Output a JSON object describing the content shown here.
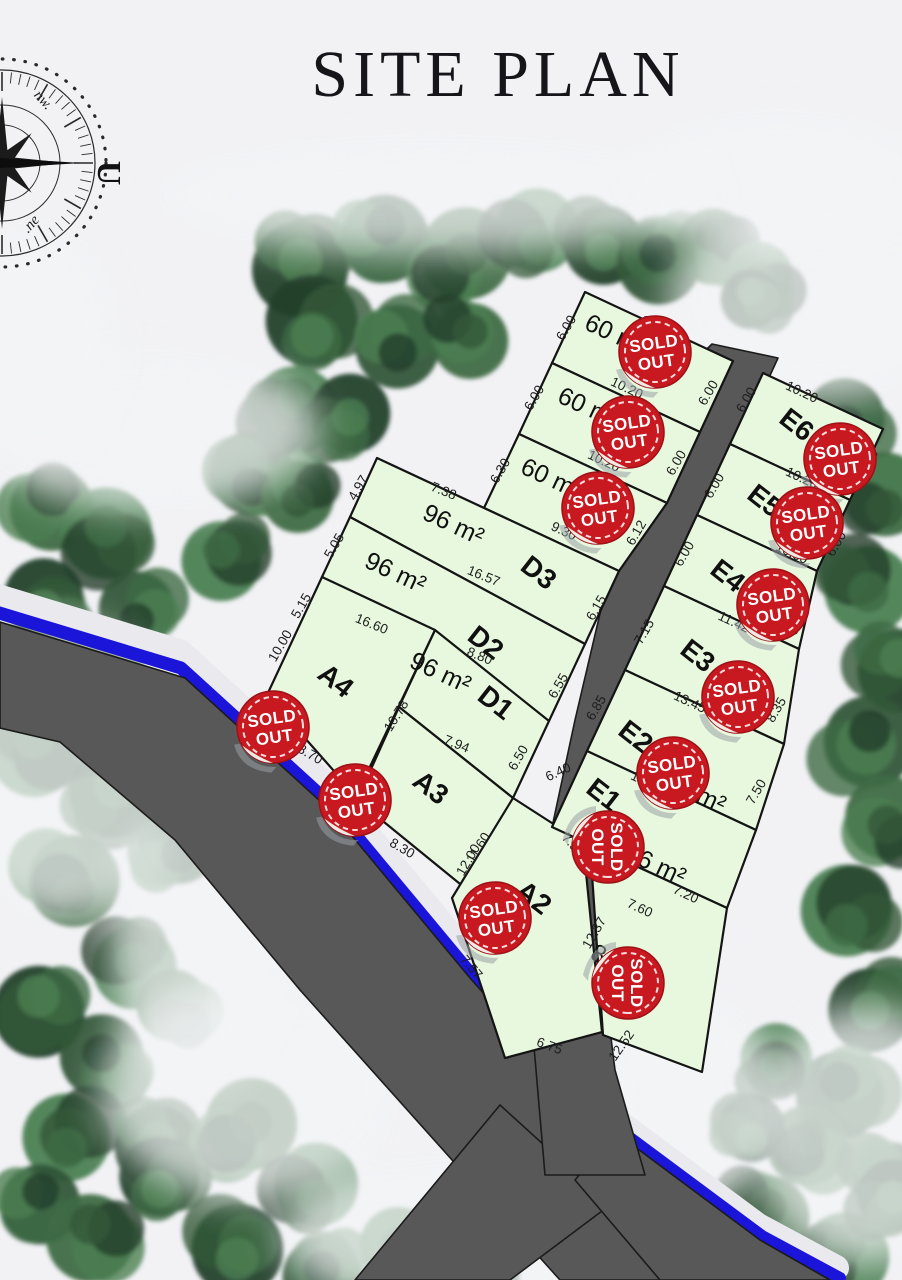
{
  "title": "SITE PLAN",
  "compass": {
    "north_label": "U",
    "nw_label": "nw.",
    "ne_label": ".ne"
  },
  "stamp": {
    "line1": "SOLD",
    "line2": "OUT",
    "color": "#c7191f"
  },
  "colors": {
    "background": "#f2f2f5",
    "plot_fill": "#e7f8de",
    "plot_border": "#141414",
    "road": "#585858",
    "water_line": "#1b15da",
    "stamp_red": "#c7191f",
    "tree_dark": "#2c4a33"
  },
  "plots": [
    {
      "id": "c1",
      "name": "",
      "area": "60 m²",
      "dims": [
        "10.20",
        "6.00",
        "10.20",
        "6.00"
      ]
    },
    {
      "id": "c2",
      "name": "",
      "area": "60 m²",
      "dims": [
        "6.00",
        "10.20",
        "6.00"
      ]
    },
    {
      "id": "c3",
      "name": "",
      "area": "60 m²",
      "dims": [
        "6.30",
        "9.30",
        "6.12"
      ]
    },
    {
      "id": "d3",
      "name": "D3",
      "area": "96 m²",
      "dims": [
        "7.38",
        "4.97",
        "16.57",
        "6.15"
      ]
    },
    {
      "id": "d2",
      "name": "D2",
      "area": "96 m²",
      "dims": [
        "5.05",
        "16.60",
        "6.55"
      ]
    },
    {
      "id": "d1",
      "name": "D1",
      "area": "96 m²",
      "dims": [
        "8.80",
        "5.15",
        "7.94",
        "6.50"
      ]
    },
    {
      "id": "a4",
      "name": "A4",
      "area": "",
      "dims": [
        "10.00",
        "8.70",
        "10.78"
      ]
    },
    {
      "id": "a3",
      "name": "A3",
      "area": "",
      "dims": [
        "8.30",
        "11.60"
      ]
    },
    {
      "id": "a2",
      "name": "A2",
      "area": "",
      "dims": [
        "12.00",
        "7.57",
        "12.37",
        "6.75"
      ]
    },
    {
      "id": "e6",
      "name": "E6",
      "area": "",
      "dims": [
        "10.20",
        "6.00",
        "10.20",
        "6.00"
      ]
    },
    {
      "id": "e5",
      "name": "E5",
      "area": "",
      "dims": [
        "6.00",
        "10.30",
        "6.00"
      ]
    },
    {
      "id": "e4",
      "name": "E4",
      "area": "",
      "dims": [
        "6.00",
        "11.42",
        "6.32"
      ]
    },
    {
      "id": "e3",
      "name": "E3",
      "area": "",
      "dims": [
        "7.15",
        "13.45",
        "8.35"
      ]
    },
    {
      "id": "e2",
      "name": "E2",
      "area": "96 m²",
      "dims": [
        "6.85",
        "14.36",
        "7.50"
      ]
    },
    {
      "id": "e1",
      "name": "E1",
      "area": "96 m²",
      "dims": [
        "6.40",
        "7.57",
        "7.60",
        "7.20"
      ]
    },
    {
      "id": "p16",
      "name": "",
      "area": "80 m²",
      "dims": [
        "12.52"
      ]
    }
  ]
}
